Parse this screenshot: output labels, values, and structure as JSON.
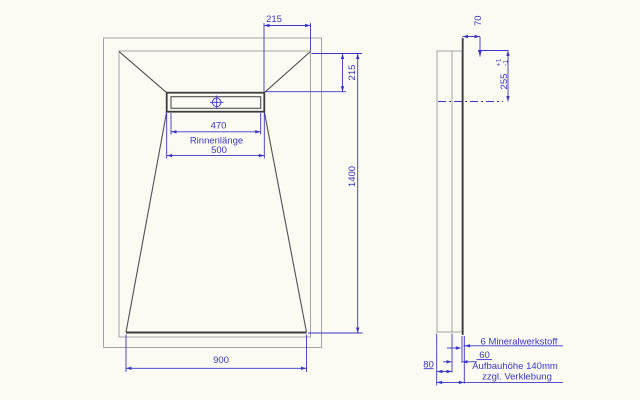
{
  "plan_view": {
    "dim_channel_end_offset": "215",
    "dim_channel_top_offset": "215",
    "dim_length": "1400",
    "dim_channel_visible_length": "470",
    "channel_label": "Rinnenlänge",
    "dim_channel_length": "500",
    "dim_width": "900"
  },
  "side_view": {
    "dim_top": "70",
    "dim_drain_axis": "255",
    "tolerance_plus": "+1",
    "tolerance_minus": "-1",
    "label_material": "6 Mineralwerkstoff",
    "dim_60": "60",
    "dim_80": "80",
    "label_buildup": "Aufbauhöhe 140mm",
    "label_buildup2": "zzgl. Verklebung"
  },
  "colors": {
    "dimension_blue": "#3b35c6",
    "outline_gray": "#a3a3a3",
    "edge_dark": "#3d3d3d",
    "background": "#fbfbf4"
  }
}
